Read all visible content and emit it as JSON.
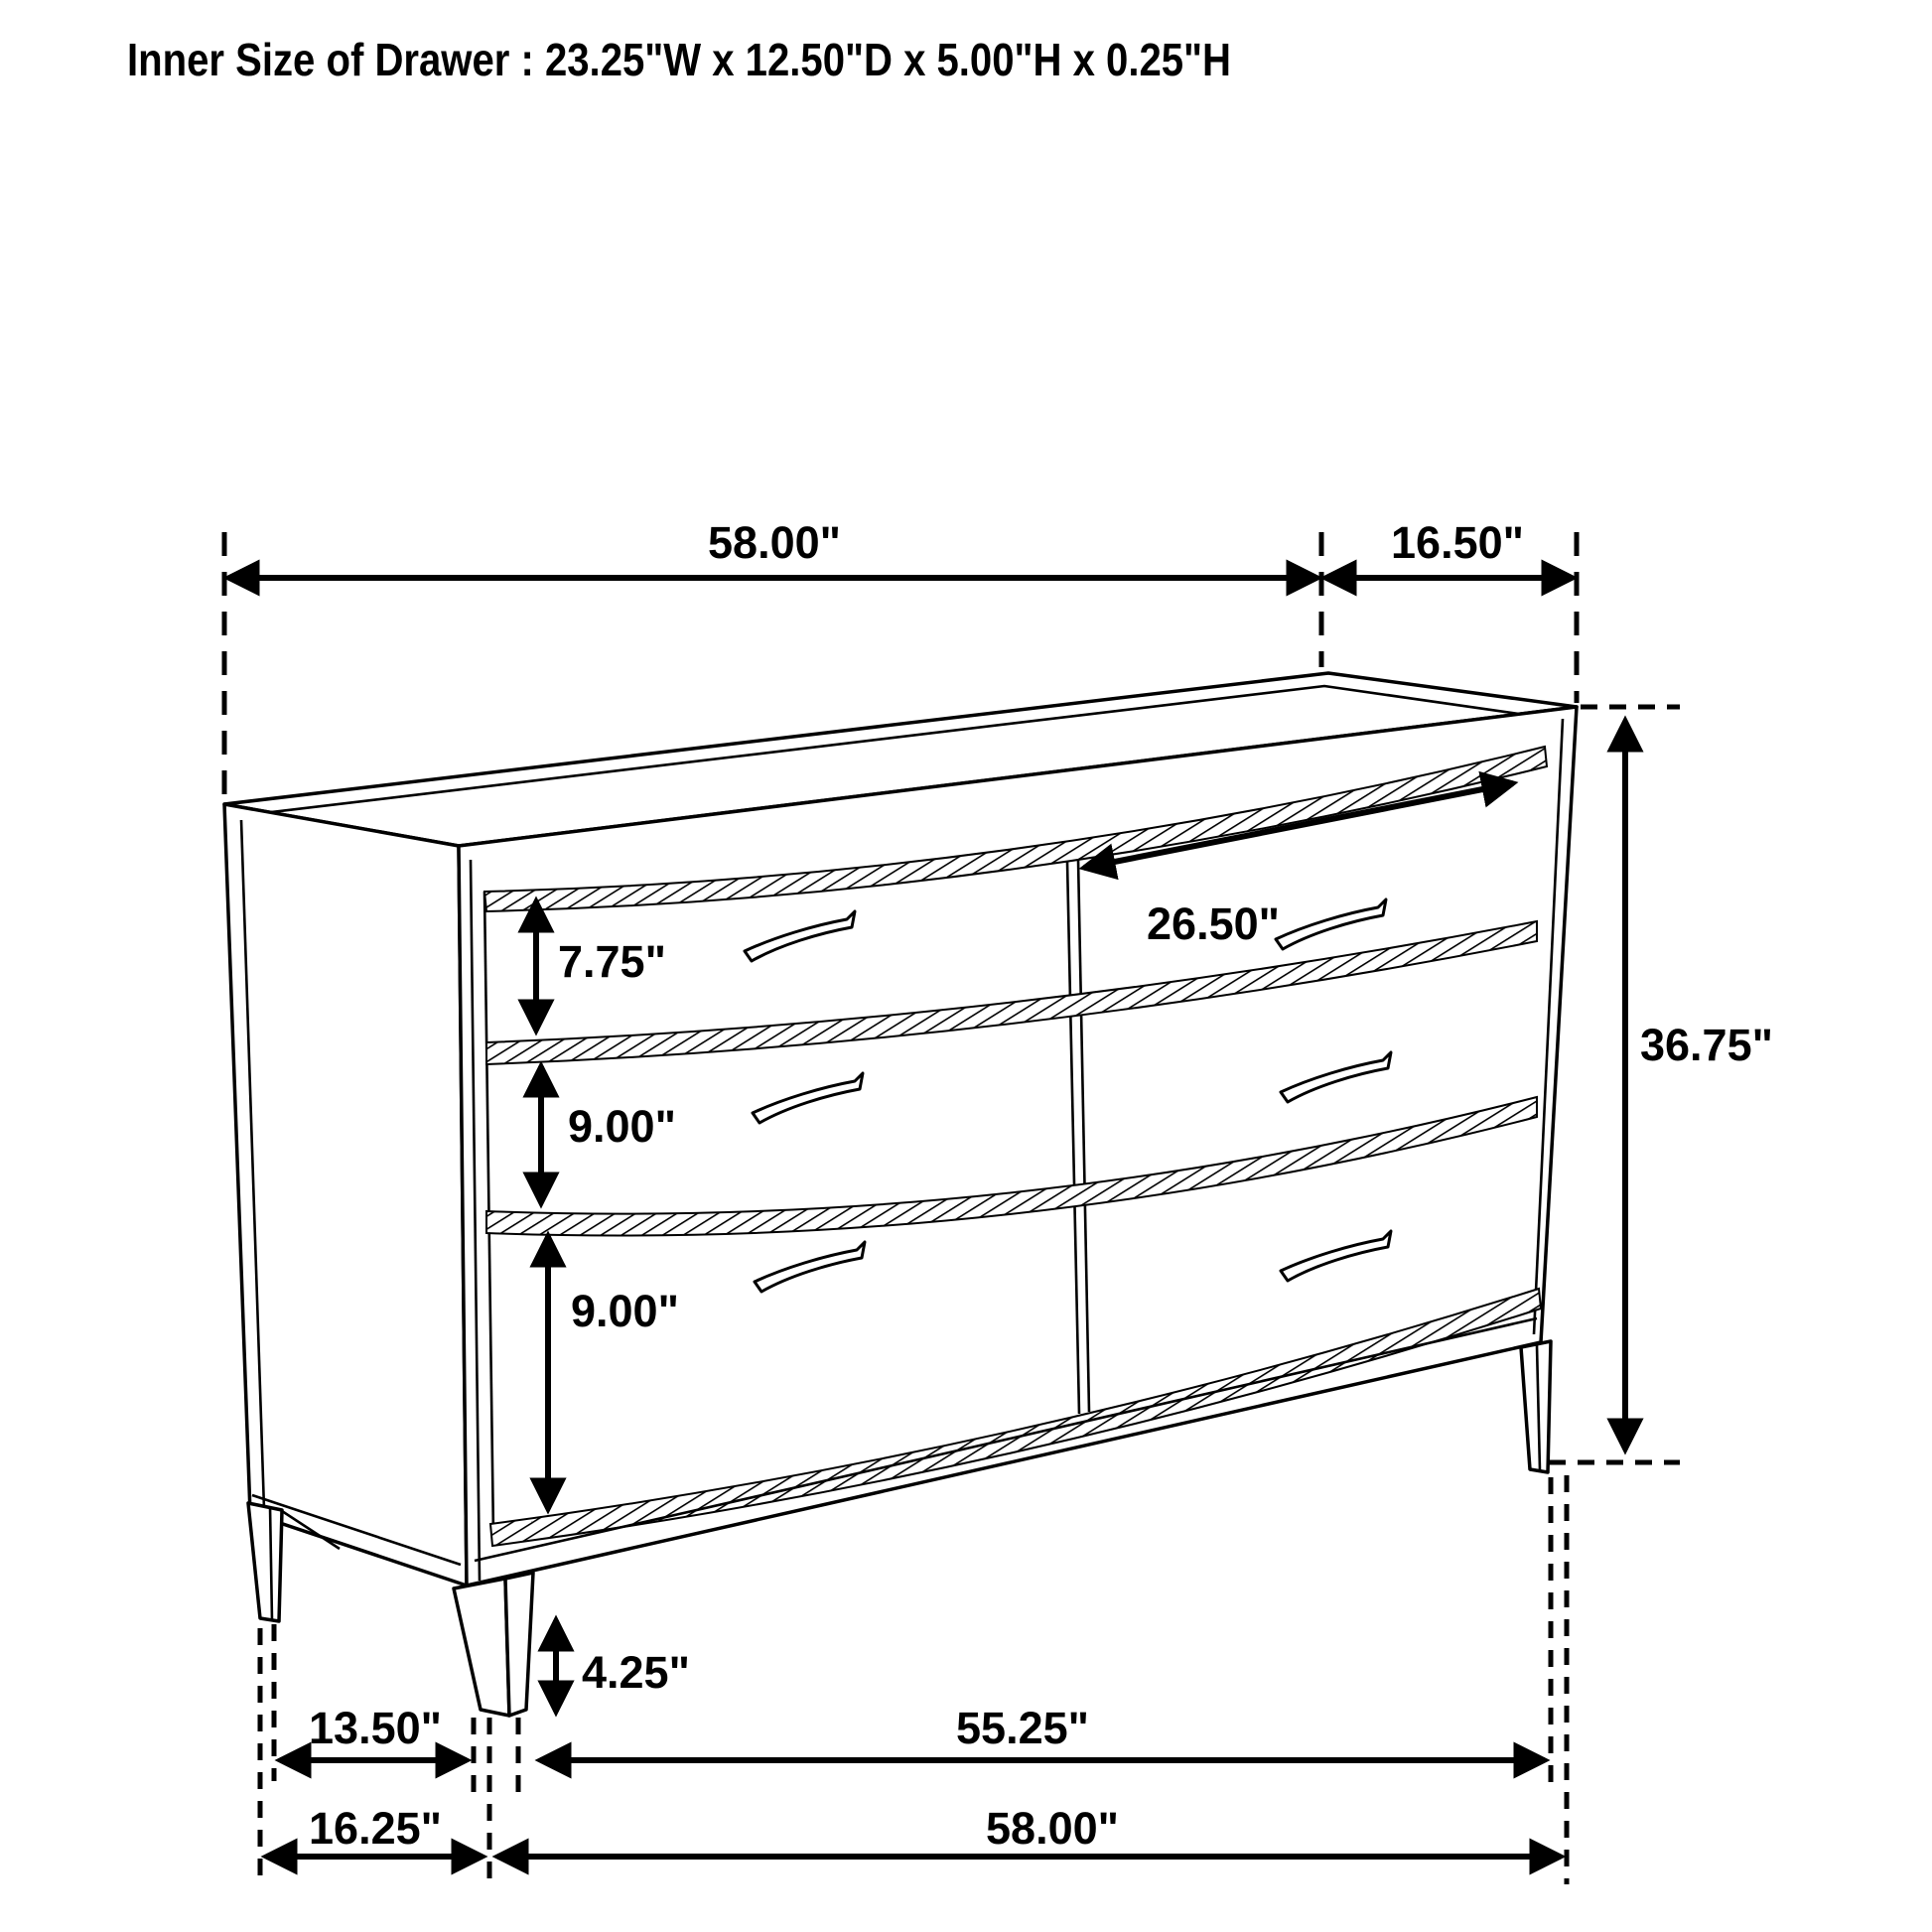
{
  "title": "Inner Size of Drawer : 23.25\"W x 12.50\"D x 5.00\"H x 0.25\"H",
  "figure": {
    "subject": "six-drawer dresser line drawing",
    "line_color": "#000000",
    "background_color": "#ffffff"
  },
  "dimensions": {
    "top_width": "58.00\"",
    "top_depth": "16.50\"",
    "drawer_opening_width": "26.50\"",
    "top_drawer_height": "7.75\"",
    "middle_drawer_height": "9.00\"",
    "bottom_drawer_height": "9.00\"",
    "overall_height": "36.75\"",
    "leg_height": "4.25\"",
    "leg_inset_depth": "13.50\"",
    "leg_span_width": "55.25\"",
    "overall_depth": "16.25\"",
    "overall_width": "58.00\""
  }
}
